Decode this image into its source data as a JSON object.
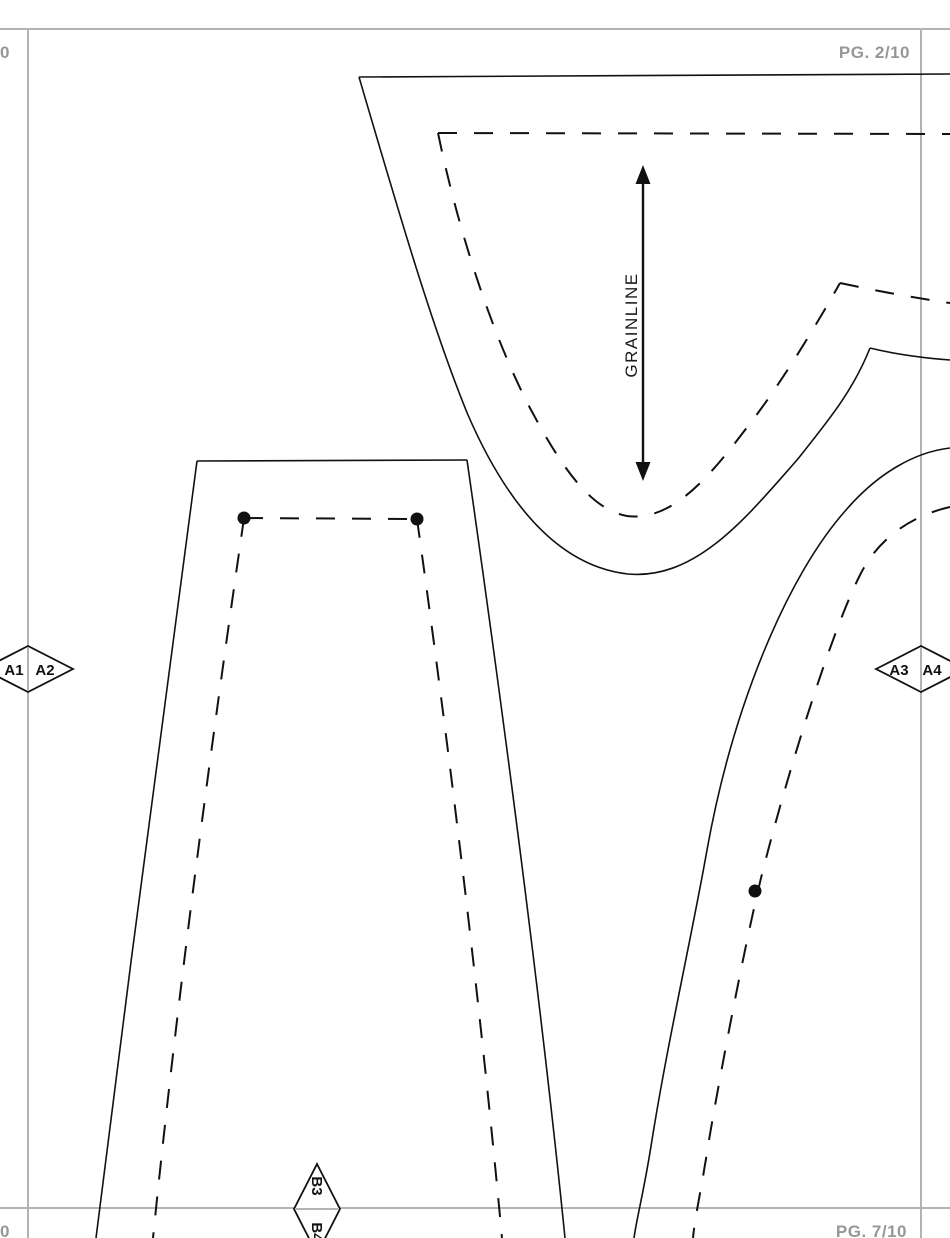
{
  "page": {
    "tile_labels": {
      "top_left": "10",
      "top_right": "PG. 2/10",
      "bottom_left": "10",
      "bottom_right": "PG. 7/10"
    },
    "grainline_label": "GRAINLINE",
    "alignment_markers": {
      "left_diamond": {
        "first": "A1",
        "second": "A2"
      },
      "right_diamond": {
        "first": "A3",
        "second": "A4"
      },
      "bottom_diamond": {
        "first": "B3",
        "second": "B4"
      }
    },
    "colors": {
      "grid_line": "#b3b3b3",
      "label_text": "#979797",
      "pattern_line": "#111111",
      "background": "#ffffff"
    }
  }
}
